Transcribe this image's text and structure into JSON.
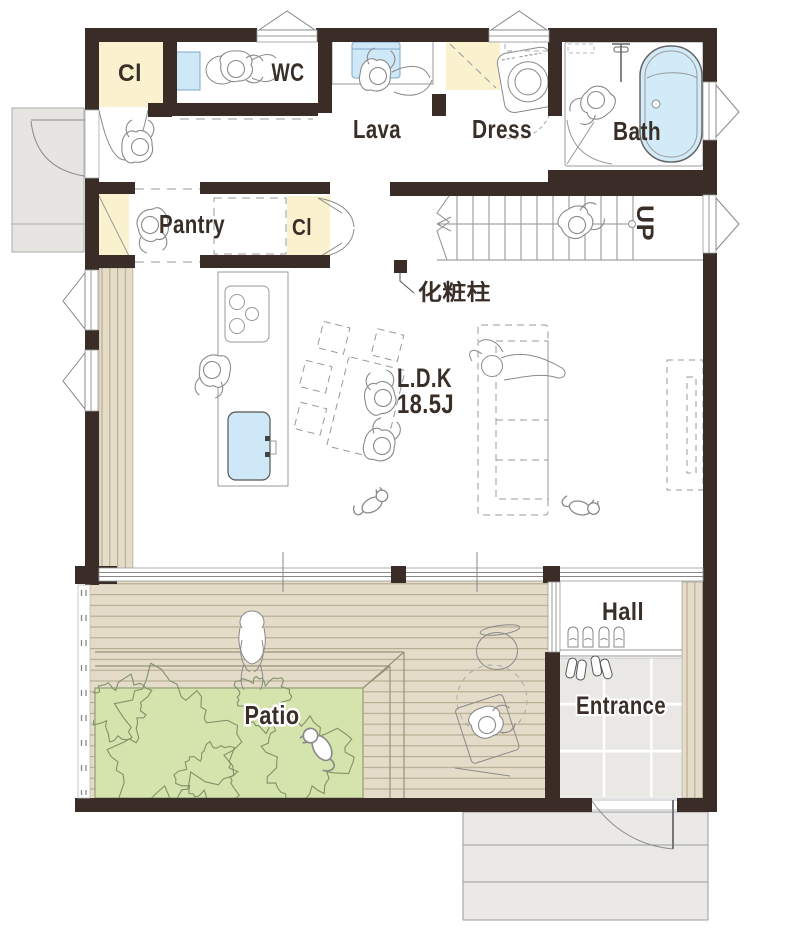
{
  "floorplan": {
    "rooms": {
      "closet_top": {
        "label": "Cl"
      },
      "wc": {
        "label": "WC"
      },
      "lavatory": {
        "label": "Lava"
      },
      "dressing": {
        "label": "Dress"
      },
      "bath": {
        "label": "Bath"
      },
      "pantry": {
        "label": "Pantry"
      },
      "closet_mid": {
        "label": "Cl"
      },
      "ldk": {
        "name": "L.D.K",
        "size": "18.5J"
      },
      "hall": {
        "label": "Hall"
      },
      "entrance": {
        "label": "Entrance"
      },
      "patio": {
        "label": "Patio"
      }
    },
    "annotations": {
      "stairs_direction": "UP",
      "pillar_note": "化粧柱"
    },
    "colors": {
      "wall": "#3a2d27",
      "closet_fill": "#faf1cf",
      "water_fill": "#cfe8f7",
      "deck_fill": "#e4dcc8",
      "deck_line": "#b4a98f",
      "patio_fill": "#d5e3ac",
      "tree_line": "#81926a",
      "tile_fill": "#e9e8e5",
      "porch_fill": "#e7e5e2",
      "outline": "#8a8a8a",
      "text": "#3a2f28"
    }
  }
}
